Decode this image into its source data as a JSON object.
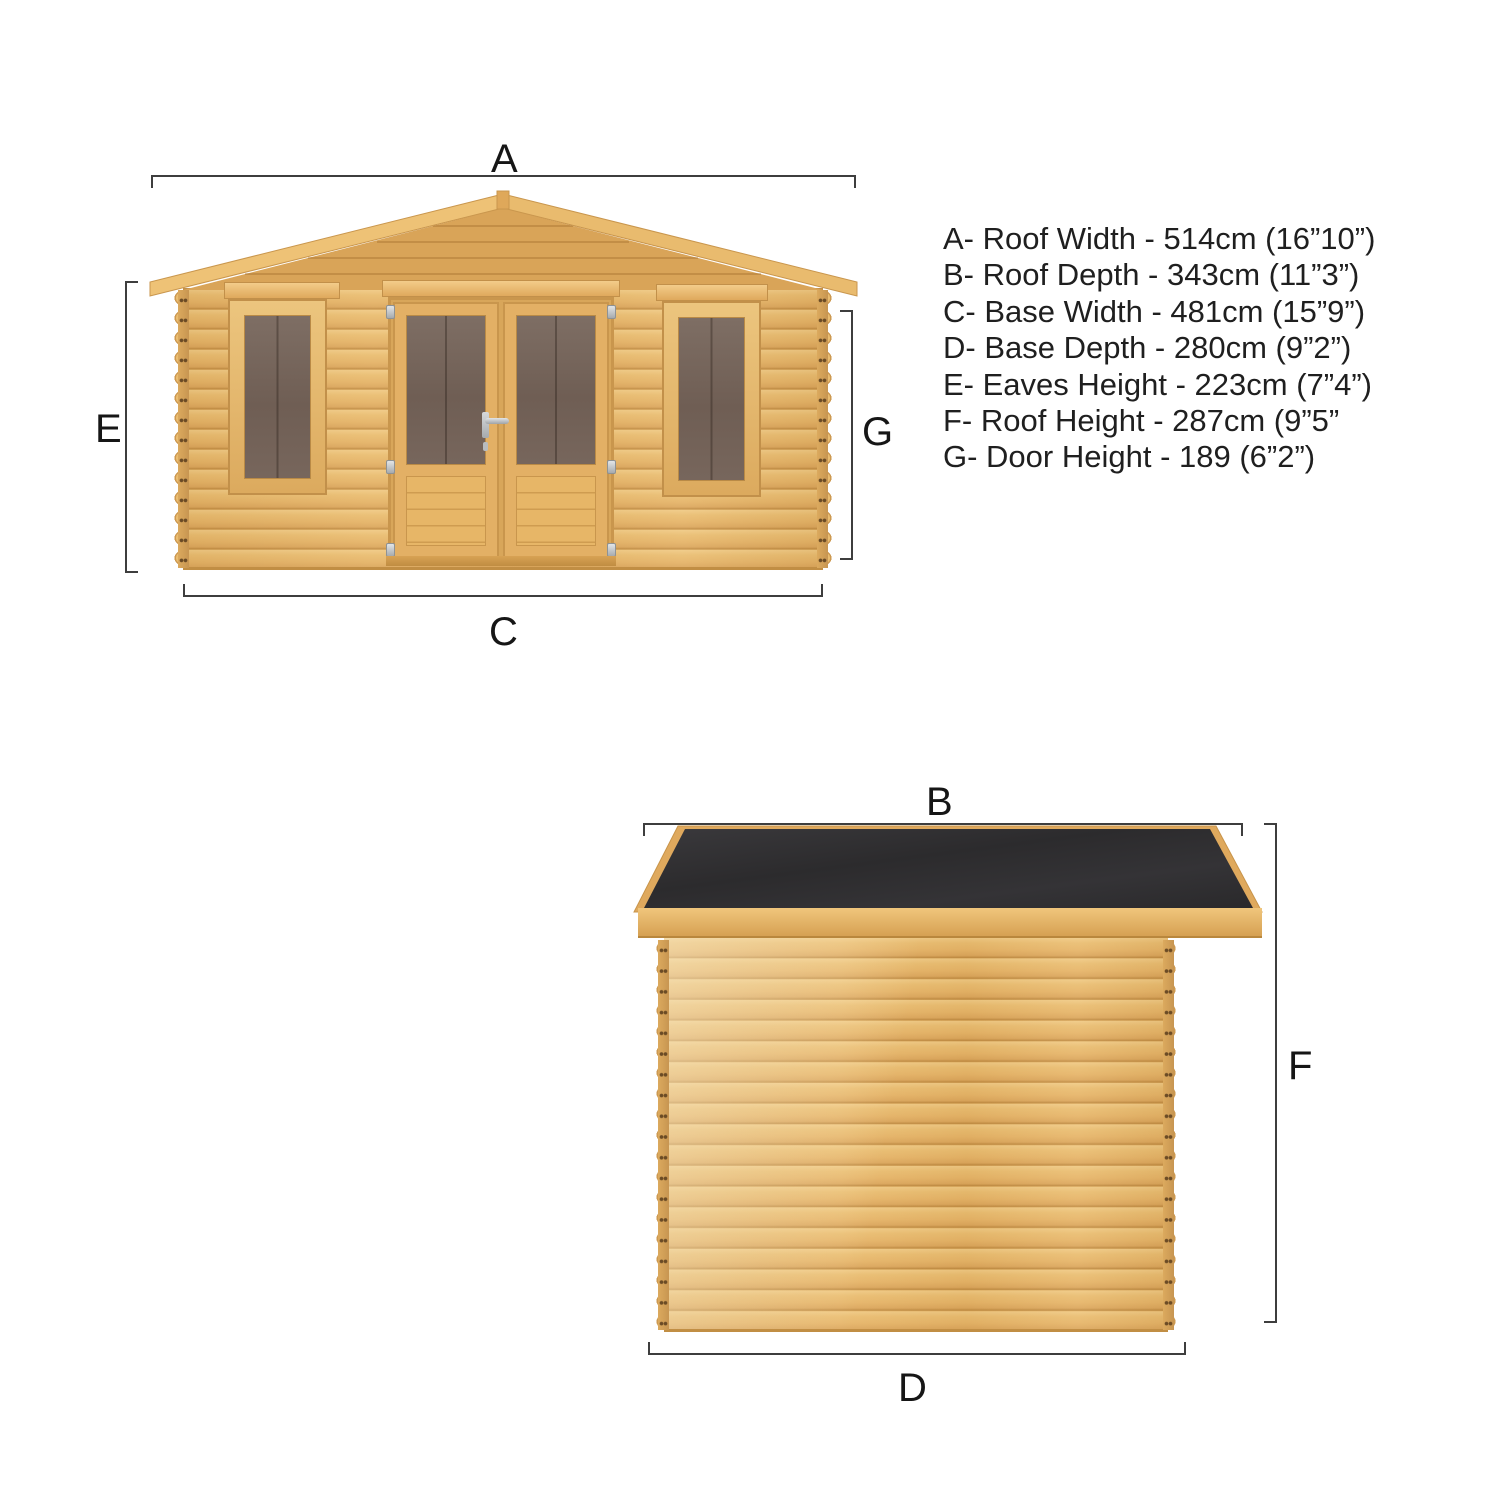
{
  "dims": {
    "a": "A",
    "b": "B",
    "c": "C",
    "d": "D",
    "e": "E",
    "f": "F",
    "g": "G"
  },
  "legend": {
    "lines": [
      "A- Roof Width - 514cm (16”10”)",
      "B- Roof Depth - 343cm (11”3”)",
      "C- Base Width - 481cm (15”9”)",
      "D- Base Depth - 280cm (9”2”)",
      "E- Eaves Height - 223cm (7”4”)",
      "F- Roof Height - 287cm (9”5”",
      "G- Door Height - 189 (6”2”)"
    ]
  },
  "colors": {
    "background": "#ffffff",
    "wood_light": "#f0c983",
    "wood_mid": "#e5b366",
    "wood_trim_dark": "#c2904a",
    "window_glass": "#6f5e54",
    "roof_felt": "#302f31",
    "dimension_line": "#3e3e3e",
    "label_text": "#161616"
  }
}
